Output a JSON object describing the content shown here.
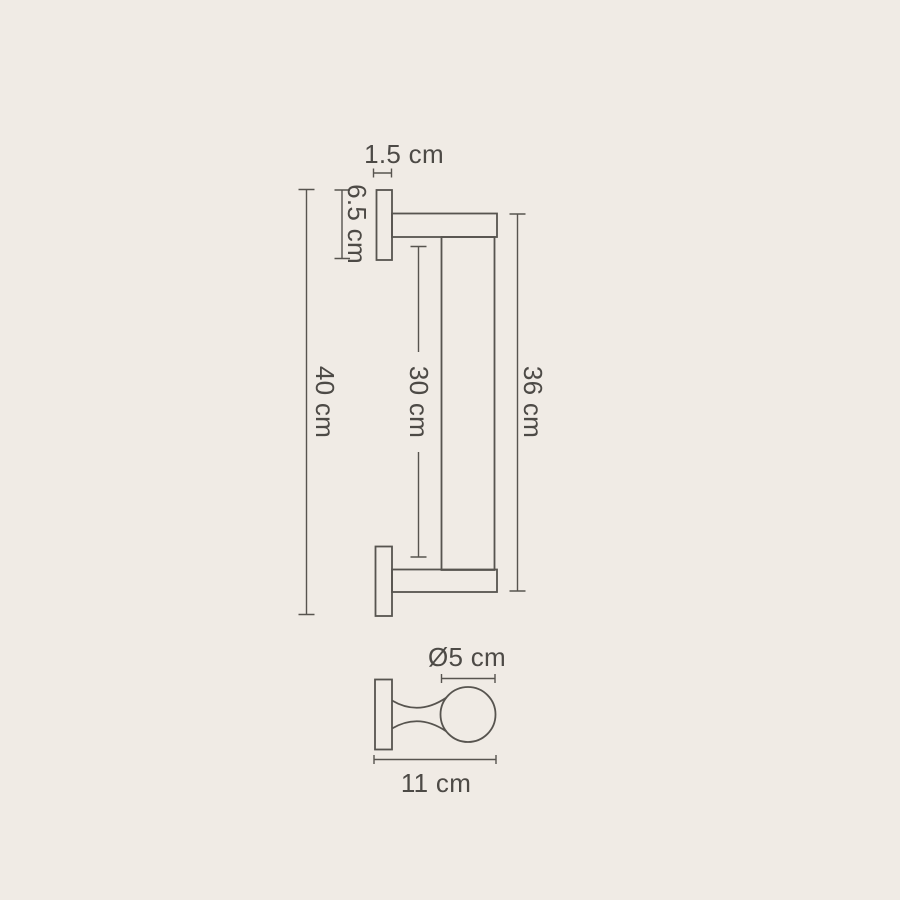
{
  "colors": {
    "background": "#f0ebe5",
    "line": "#57544f",
    "text": "#4d4a46"
  },
  "diagram": {
    "type": "technical-dimension-drawing",
    "subject": "wall-mounted bar rail, front elevation and side profile",
    "views": [
      {
        "name": "front-elevation"
      },
      {
        "name": "side-profile"
      }
    ],
    "labels": {
      "plate_thickness": "1.5 cm",
      "plate_height": "6.5 cm",
      "overall_height": "40 cm",
      "inner_length": "30 cm",
      "bar_length": "36 cm",
      "bar_diameter": "Ø5 cm",
      "projection_depth": "11 cm"
    }
  }
}
